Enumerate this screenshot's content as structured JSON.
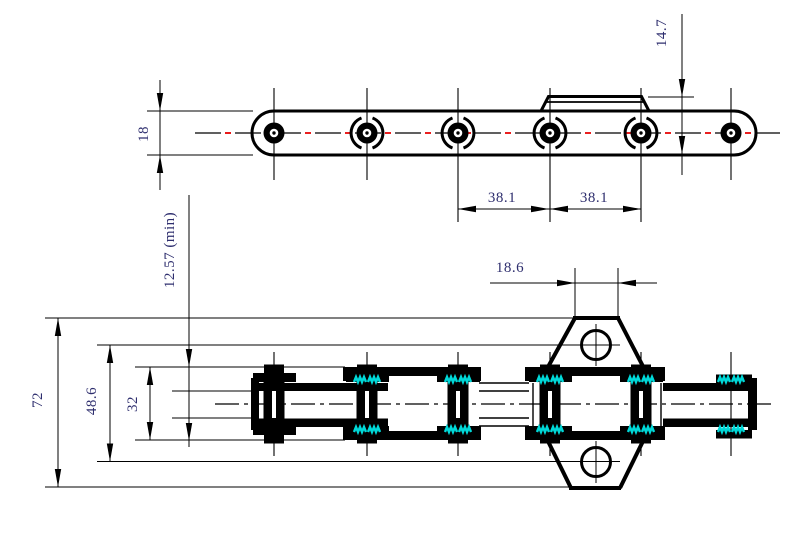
{
  "drawing": {
    "description": "double-pitch roller chain with bent attachment plates, two orthographic views"
  },
  "dimensions": {
    "chain_width": "18",
    "attachment_drop": "14.7",
    "pitch_1": "38.1",
    "pitch_2": "38.1",
    "attachment_top_width": "18.6",
    "inner_clearance": "12.57 (min)",
    "attachment_overall_height": "72",
    "hole_center_span": "48.6",
    "plate_outer_span": "32"
  },
  "colors": {
    "line": "#000000",
    "centerline_red": "#e60000",
    "weld_cyan": "#00d9d9",
    "dim_text": "#2e2e6e",
    "background": "#ffffff"
  }
}
